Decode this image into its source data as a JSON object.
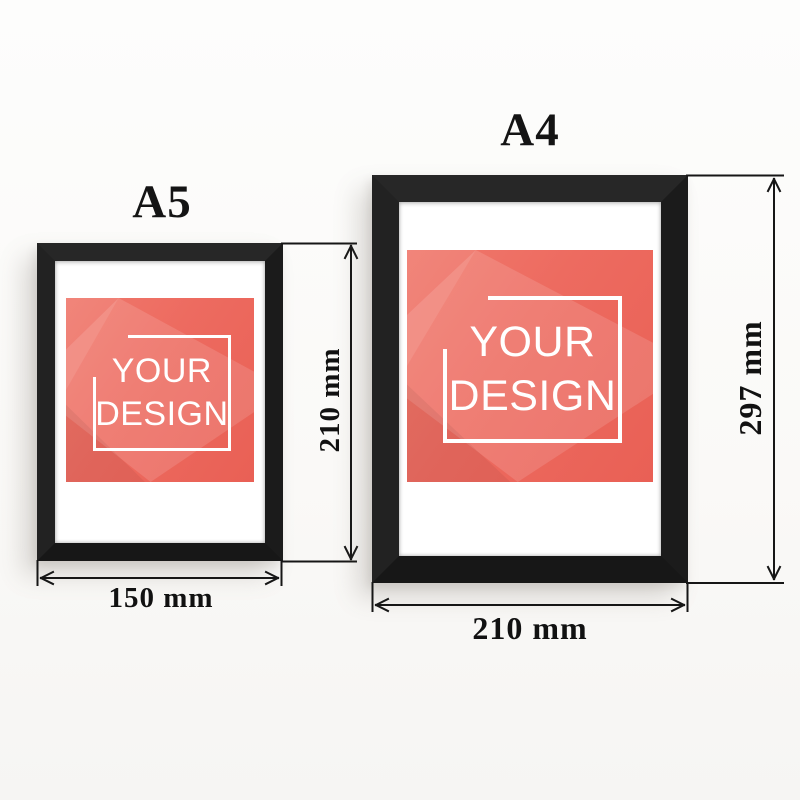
{
  "frames": [
    {
      "name": "A5",
      "width_label": "150 mm",
      "height_label": "210 mm",
      "design_line1": "YOUR",
      "design_line2": "DESIGN"
    },
    {
      "name": "A4",
      "width_label": "210 mm",
      "height_label": "297 mm",
      "design_line1": "YOUR",
      "design_line2": "DESIGN"
    }
  ],
  "colors": {
    "frame_black": "#1d1d1d",
    "mat_white": "#ffffff",
    "design_coral": "#ec6a5e",
    "design_text": "#ffffff",
    "dimension_line": "#161616",
    "background": "#fbfaf8"
  }
}
